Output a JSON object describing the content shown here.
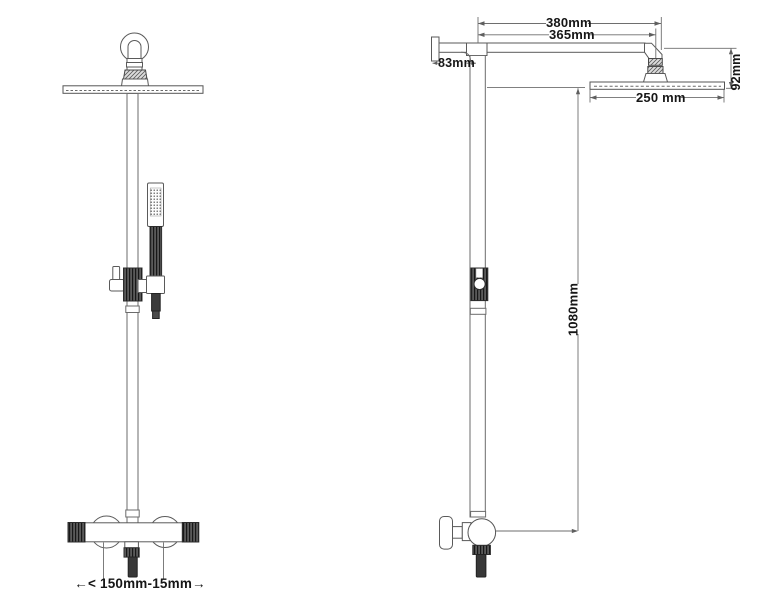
{
  "labels": {
    "arm_total": "380mm",
    "arm_length": "365mm",
    "wall_offset": "83mm",
    "head_height": "92mm",
    "head_width": "250 mm",
    "column_height": "1080mm",
    "inlet_spacing": "←< 150mm-15mm→"
  },
  "colors": {
    "line": "#5a5a5a",
    "pipe_line": "#6b6b6b",
    "dim_line": "#6e6e6e",
    "dark_fill": "#383838",
    "text": "#161616",
    "background": "#ffffff"
  }
}
